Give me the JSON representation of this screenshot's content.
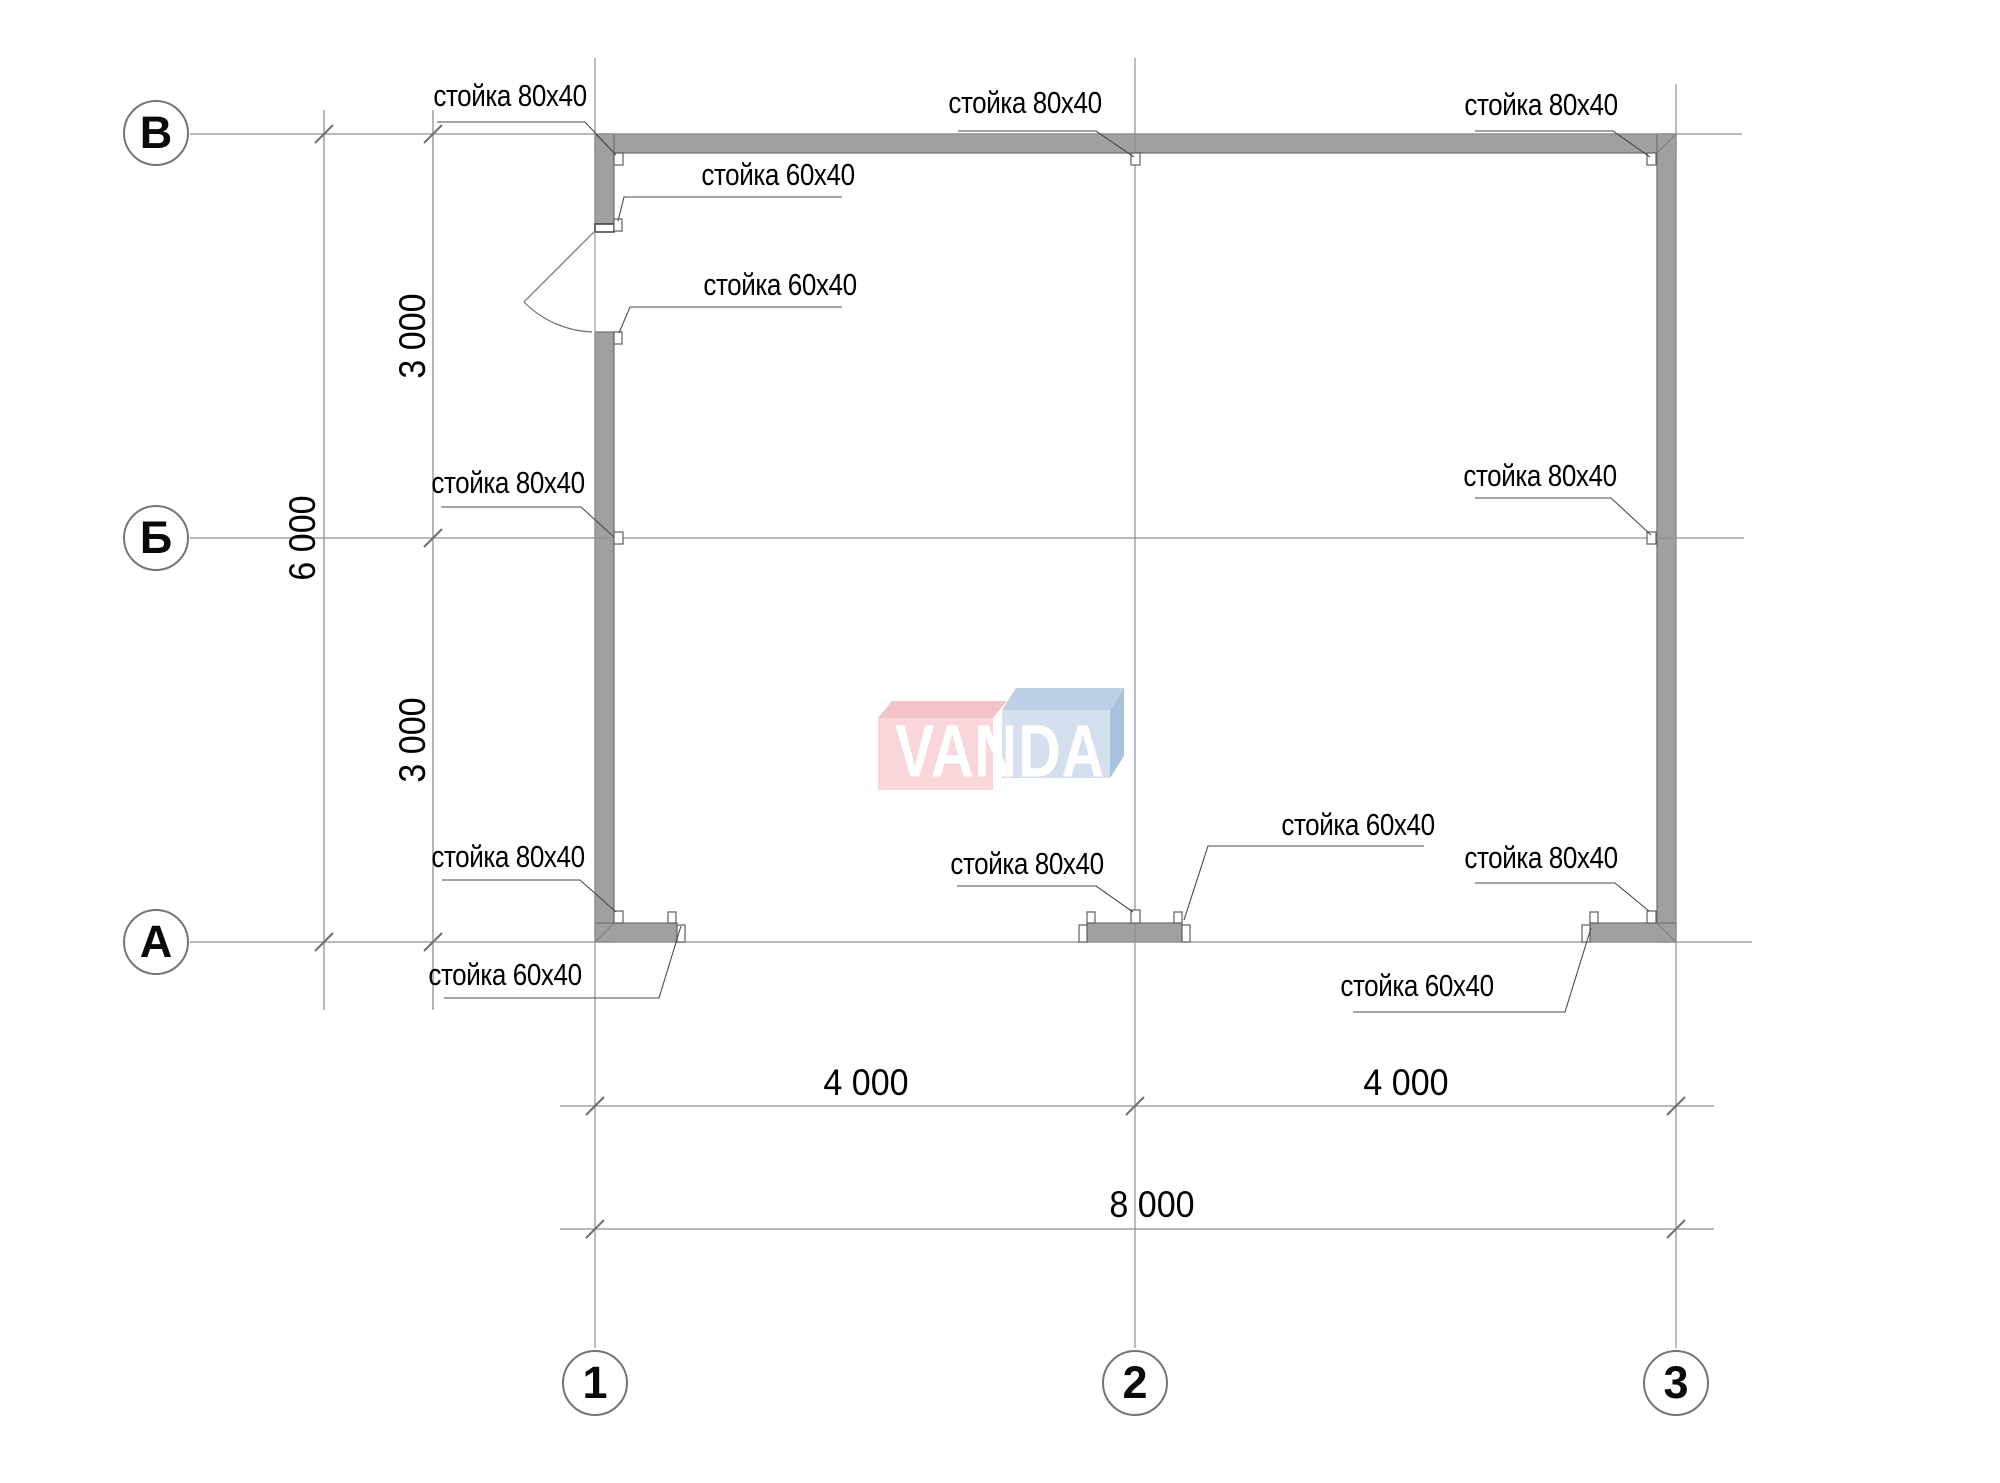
{
  "title": "Каркасный план 8000x6000",
  "axis_circles": {
    "rows": [
      "В",
      "Б",
      "А"
    ],
    "cols": [
      "1",
      "2",
      "3"
    ]
  },
  "dimensions": {
    "vertical": {
      "segment_upper": "3 000",
      "segment_lower": "3 000",
      "total": "6 000"
    },
    "horizontal": {
      "segment_left": "4 000",
      "segment_right": "4 000",
      "total": "8 000"
    }
  },
  "callouts": [
    {
      "label": "стойка 80х40"
    },
    {
      "label": "стойка 80х40"
    },
    {
      "label": "стойка 80х40"
    },
    {
      "label": "стойка 60х40"
    },
    {
      "label": "стойка 60х40"
    },
    {
      "label": "стойка 80х40"
    },
    {
      "label": "стойка 80х40"
    },
    {
      "label": "стойка 80х40"
    },
    {
      "label": "стойка 60х40"
    },
    {
      "label": "стойка 80х40"
    },
    {
      "label": "стойка 60х40"
    },
    {
      "label": "стойка 60х40"
    },
    {
      "label": "стойка 80х40"
    }
  ],
  "watermark": {
    "text": "VANDA",
    "pink_front": "#f8d6d9",
    "pink_top": "#f2c4ca",
    "blue_front": "#d4e0ee",
    "blue_top": "#bdd0e6",
    "blue_side": "#a8c2de",
    "letter_color": "#ffffff"
  },
  "colors": {
    "wall_fill": "#a0a0a0",
    "wall_stroke": "#6f6f6f",
    "grid_line": "#8f8f8f",
    "leader_line": "#4a4a4a",
    "text": "#000000"
  }
}
